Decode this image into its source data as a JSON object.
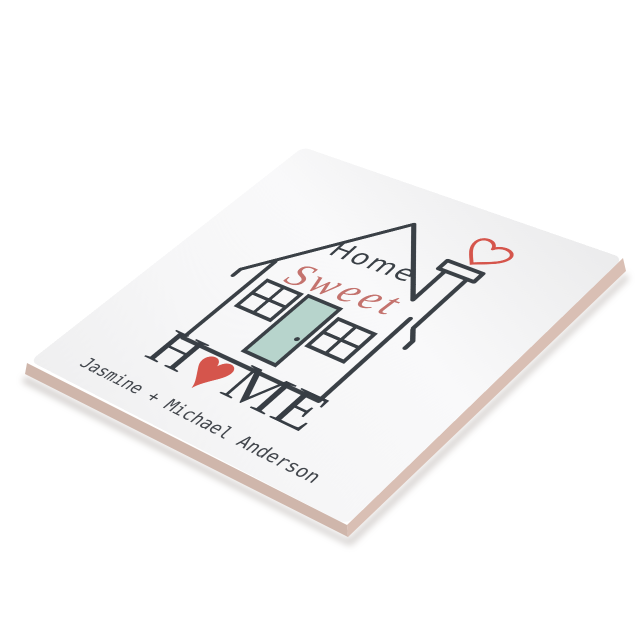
{
  "design": {
    "home_top": "Home",
    "sweet": "Sweet",
    "big_home": {
      "h": "H",
      "heart": "♥",
      "me": "ME"
    },
    "names": "Jasmine + Michael Anderson"
  },
  "colors": {
    "line_dark": "#3a4046",
    "accent_red": "#d5554c",
    "script_red": "#c4736e",
    "door_teal": "#b7d4cc",
    "tile_surface": "#f6f6f7",
    "tile_edge_pink_left": "#cfb6ab",
    "tile_edge_pink_right": "#d9bfb4",
    "background": "#ffffff"
  }
}
